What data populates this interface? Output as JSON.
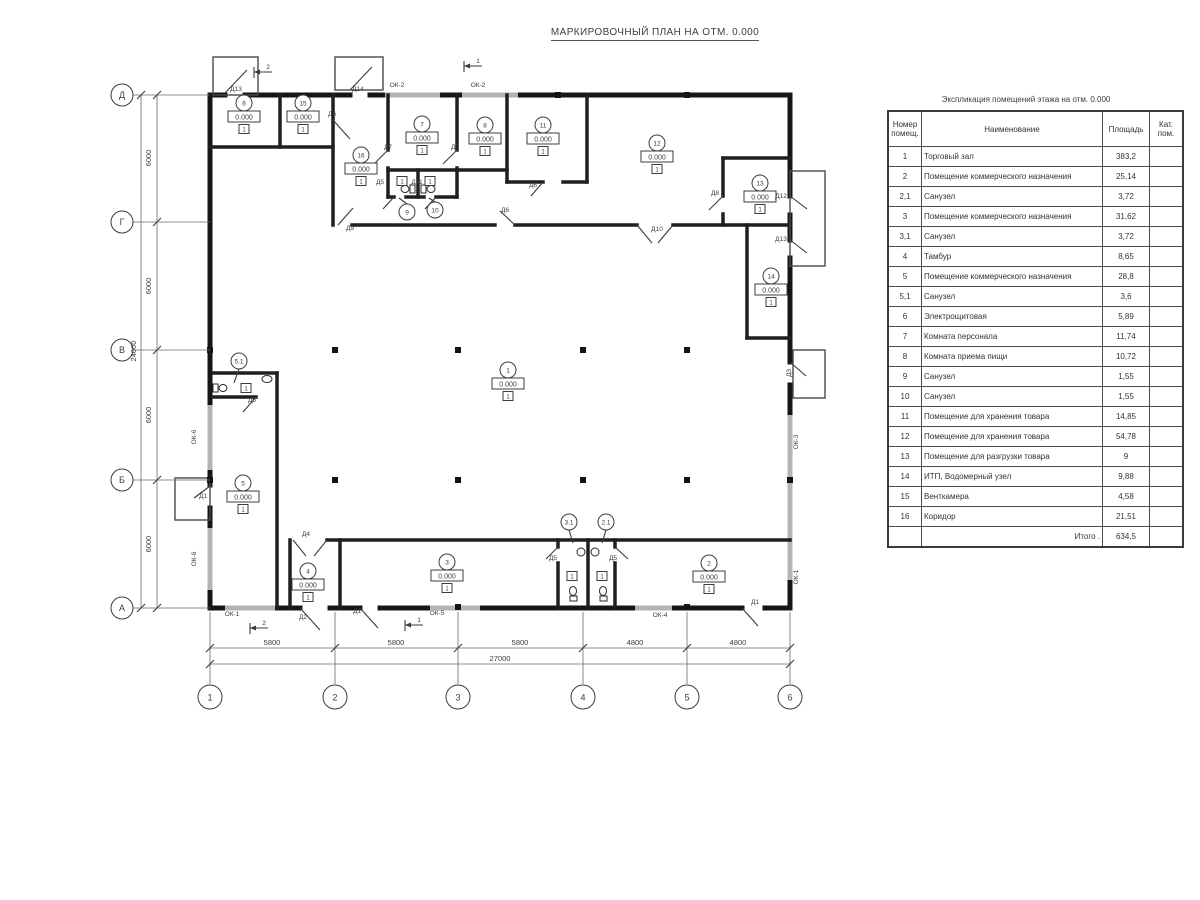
{
  "title": "МАРКИРОВОЧНЫЙ ПЛАН НА ОТМ. 0.000",
  "table": {
    "title": "Экспликация помещений этажа на отм. 0.000",
    "headers": {
      "num": "Номер\nпомещ.",
      "name": "Наименование",
      "area": "Площадь",
      "cat": "Кат.\nпом."
    },
    "rows": [
      {
        "num": "1",
        "name": "Торговый зал",
        "area": "383,2",
        "cat": ""
      },
      {
        "num": "2",
        "name": "Помещение коммерческого назначения",
        "area": "25,14",
        "cat": ""
      },
      {
        "num": "2,1",
        "name": "Санузел",
        "area": "3,72",
        "cat": ""
      },
      {
        "num": "3",
        "name": "Помещение коммерческого назначения",
        "area": "31,62",
        "cat": ""
      },
      {
        "num": "3,1",
        "name": "Санузел",
        "area": "3,72",
        "cat": ""
      },
      {
        "num": "4",
        "name": "Тамбур",
        "area": "8,65",
        "cat": ""
      },
      {
        "num": "5",
        "name": "Помещение коммерческого назначения",
        "area": "28,8",
        "cat": ""
      },
      {
        "num": "5,1",
        "name": "Санузел",
        "area": "3,6",
        "cat": ""
      },
      {
        "num": "6",
        "name": "Электрощитовая",
        "area": "5,89",
        "cat": ""
      },
      {
        "num": "7",
        "name": "Комната персонала",
        "area": "11,74",
        "cat": ""
      },
      {
        "num": "8",
        "name": "Комната приема пищи",
        "area": "10,72",
        "cat": ""
      },
      {
        "num": "9",
        "name": "Санузел",
        "area": "1,55",
        "cat": ""
      },
      {
        "num": "10",
        "name": "Санузел",
        "area": "1,55",
        "cat": ""
      },
      {
        "num": "11",
        "name": "Помещение для хранения товара",
        "area": "14,85",
        "cat": ""
      },
      {
        "num": "12",
        "name": "Помещение для хранения товара",
        "area": "54,78",
        "cat": ""
      },
      {
        "num": "13",
        "name": "Помещение для разгрузки товара",
        "area": "9",
        "cat": ""
      },
      {
        "num": "14",
        "name": "ИТП, Водомерный узел",
        "area": "9,88",
        "cat": ""
      },
      {
        "num": "15",
        "name": "Венткамера",
        "area": "4,58",
        "cat": ""
      },
      {
        "num": "16",
        "name": "Коридор",
        "area": "21,51",
        "cat": ""
      }
    ],
    "total_label": "Итого .",
    "total_value": "634,5"
  },
  "plan": {
    "elevation": "0.000",
    "floor_type": "1",
    "axis_rows": [
      {
        "label": "Д",
        "y": 95
      },
      {
        "label": "Г",
        "y": 222
      },
      {
        "label": "В",
        "y": 350
      },
      {
        "label": "Б",
        "y": 480
      },
      {
        "label": "А",
        "y": 608
      }
    ],
    "axis_cols": [
      {
        "label": "1",
        "x": 210
      },
      {
        "label": "2",
        "x": 335
      },
      {
        "label": "3",
        "x": 458
      },
      {
        "label": "4",
        "x": 583
      },
      {
        "label": "5",
        "x": 687
      },
      {
        "label": "6",
        "x": 790
      }
    ],
    "dims_left_segments": [
      {
        "text": "6000",
        "y": 158
      },
      {
        "text": "6000",
        "y": 286
      },
      {
        "text": "6000",
        "y": 415
      },
      {
        "text": "6000",
        "y": 544
      }
    ],
    "dims_left_total": {
      "text": "24000",
      "y": 351
    },
    "dims_bottom_segments": [
      {
        "text": "5800",
        "x": 272
      },
      {
        "text": "5800",
        "x": 396
      },
      {
        "text": "5800",
        "x": 520
      },
      {
        "text": "4800",
        "x": 635
      },
      {
        "text": "4800",
        "x": 738
      }
    ],
    "dims_bottom_total": {
      "text": "27000",
      "x": 500
    },
    "room_tags": [
      {
        "n": "1",
        "x": 508,
        "y": 370
      },
      {
        "n": "2",
        "x": 709,
        "y": 563
      },
      {
        "n": "3",
        "x": 447,
        "y": 562
      },
      {
        "n": "4",
        "x": 308,
        "y": 571
      },
      {
        "n": "5",
        "x": 243,
        "y": 483
      },
      {
        "n": "6",
        "x": 244,
        "y": 103
      },
      {
        "n": "7",
        "x": 422,
        "y": 124
      },
      {
        "n": "8",
        "x": 485,
        "y": 125
      },
      {
        "n": "11",
        "x": 543,
        "y": 125
      },
      {
        "n": "12",
        "x": 657,
        "y": 143
      },
      {
        "n": "13",
        "x": 760,
        "y": 183
      },
      {
        "n": "14",
        "x": 771,
        "y": 276
      },
      {
        "n": "15",
        "x": 303,
        "y": 103
      },
      {
        "n": "16",
        "x": 361,
        "y": 155
      }
    ],
    "leader_tags": [
      {
        "n": "5.1",
        "x": 239,
        "y": 361,
        "lx": 234,
        "ly": 383
      },
      {
        "n": "9",
        "x": 407,
        "y": 212,
        "lx": 399,
        "ly": 198
      },
      {
        "n": "10",
        "x": 435,
        "y": 210,
        "lx": 429,
        "ly": 198
      },
      {
        "n": "3.1",
        "x": 569,
        "y": 522,
        "lx": 573,
        "ly": 543
      },
      {
        "n": "2.1",
        "x": 606,
        "y": 522,
        "lx": 602,
        "ly": 543
      }
    ],
    "floor_marks": [
      {
        "x": 402,
        "y": 181
      },
      {
        "x": 430,
        "y": 181
      },
      {
        "x": 246,
        "y": 388
      },
      {
        "x": 572,
        "y": 576
      },
      {
        "x": 602,
        "y": 576
      }
    ],
    "door_labels": [
      {
        "text": "Д13",
        "x": 236,
        "y": 91
      },
      {
        "text": "Д14",
        "x": 358,
        "y": 91
      },
      {
        "text": "Д6",
        "x": 332,
        "y": 116
      },
      {
        "text": "Д7",
        "x": 388,
        "y": 149
      },
      {
        "text": "Д7",
        "x": 455,
        "y": 149
      },
      {
        "text": "Д5",
        "x": 380,
        "y": 184
      },
      {
        "text": "Д11",
        "x": 417,
        "y": 184
      },
      {
        "text": "Д9",
        "x": 350,
        "y": 230
      },
      {
        "text": "Д6",
        "x": 533,
        "y": 187
      },
      {
        "text": "Д6",
        "x": 505,
        "y": 212
      },
      {
        "text": "Д10",
        "x": 657,
        "y": 231
      },
      {
        "text": "Д8",
        "x": 715,
        "y": 195
      },
      {
        "text": "Д12",
        "x": 781,
        "y": 198
      },
      {
        "text": "Д13",
        "x": 781,
        "y": 241
      },
      {
        "text": "Д3",
        "x": 791,
        "y": 373,
        "rot": true
      },
      {
        "text": "Д5",
        "x": 252,
        "y": 402
      },
      {
        "text": "Д1",
        "x": 203,
        "y": 498
      },
      {
        "text": "Д4",
        "x": 306,
        "y": 536
      },
      {
        "text": "Д2",
        "x": 303,
        "y": 619
      },
      {
        "text": "Д1",
        "x": 357,
        "y": 613
      },
      {
        "text": "Д5",
        "x": 553,
        "y": 560
      },
      {
        "text": "Д5",
        "x": 613,
        "y": 560
      },
      {
        "text": "Д1",
        "x": 755,
        "y": 604
      }
    ],
    "window_labels": [
      {
        "text": "ОК-2",
        "x": 397,
        "y": 87
      },
      {
        "text": "ОК-2",
        "x": 478,
        "y": 87
      },
      {
        "text": "ОК-6",
        "x": 196,
        "y": 437,
        "rot": true
      },
      {
        "text": "ОК-6",
        "x": 196,
        "y": 559,
        "rot": true
      },
      {
        "text": "ОК-1",
        "x": 232,
        "y": 616
      },
      {
        "text": "ОК-5",
        "x": 437,
        "y": 615
      },
      {
        "text": "ОК-4",
        "x": 660,
        "y": 617
      },
      {
        "text": "ОК-3",
        "x": 798,
        "y": 442,
        "rot": true
      },
      {
        "text": "ОК-1",
        "x": 798,
        "y": 577,
        "rot": true
      }
    ],
    "section_marks": [
      {
        "n": "2",
        "x": 262,
        "y": 66
      },
      {
        "n": "1",
        "x": 472,
        "y": 60
      },
      {
        "n": "2",
        "x": 258,
        "y": 622
      },
      {
        "n": "1",
        "x": 413,
        "y": 619
      }
    ]
  }
}
